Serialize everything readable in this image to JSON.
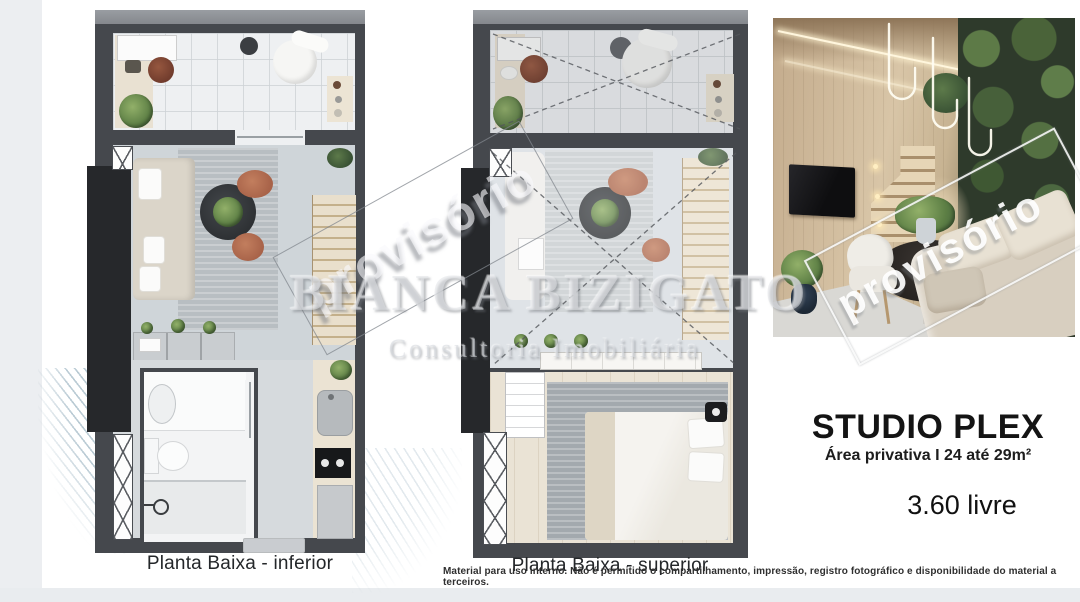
{
  "plans": {
    "inferior_label": "Planta Baixa - inferior",
    "superior_label": "Planta Baixa - superior"
  },
  "studio": {
    "title": "STUDIO PLEX",
    "area": "Área privativa I 24 até 29m²",
    "ceiling_height": "3.60 livre"
  },
  "watermark": {
    "provisional": "provisório",
    "provisional_photo": "provisório",
    "brand": "BIANCA BIZIGATO",
    "brand_tagline": "Consultoria Imobiliária"
  },
  "disclaimer": "Material para uso interno. Não é permitido o compartilhamento, impressão, registro fotográfico e disponibilidade do material a terceiros.",
  "colors": {
    "wall": "#45484d",
    "slab": "#8f9297",
    "floor": "#cfd5d9",
    "terracotta": "#b57054",
    "panel": "#26282b"
  }
}
